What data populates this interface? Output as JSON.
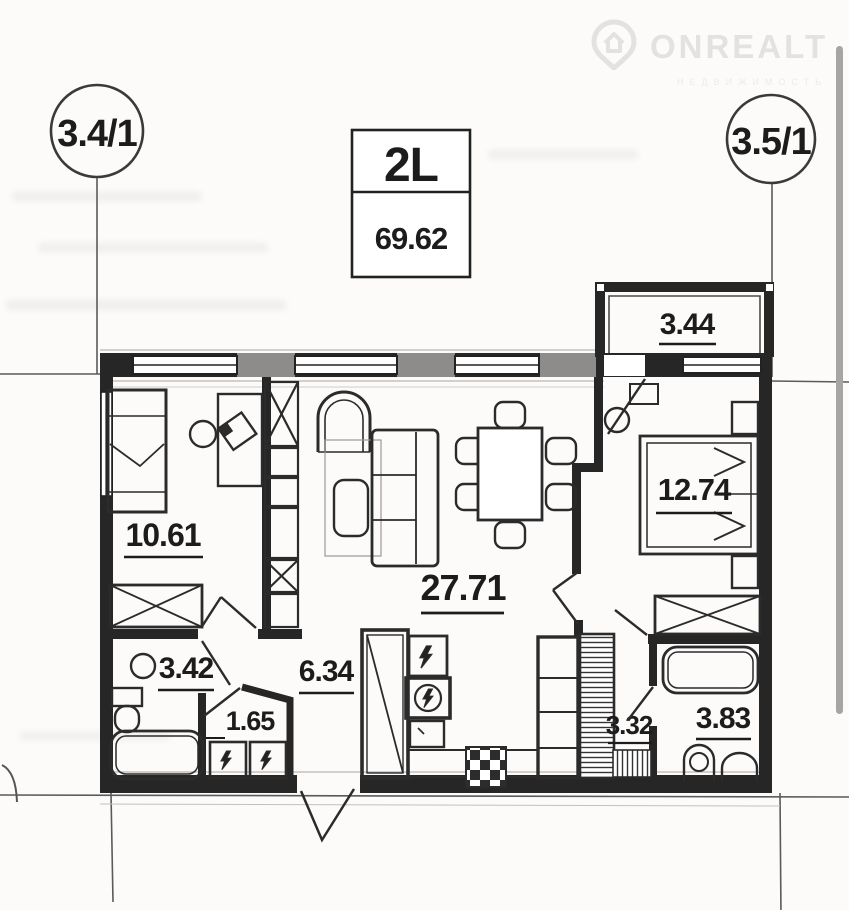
{
  "watermark": {
    "brand": "ONREALT",
    "tagline": "НЕДВИЖИМОСТЬ"
  },
  "axis_markers": {
    "left": "3.4/1",
    "right": "3.5/1"
  },
  "title_block": {
    "unit_type": "2L",
    "total_area": "69.62"
  },
  "rooms": {
    "balcony": "3.44",
    "bedroom1": "10.61",
    "living": "27.71",
    "bedroom2": "12.74",
    "bathroom1": "3.42",
    "storage": "1.65",
    "hallway": "6.34",
    "corridor": "3.32",
    "bathroom2": "3.83"
  }
}
